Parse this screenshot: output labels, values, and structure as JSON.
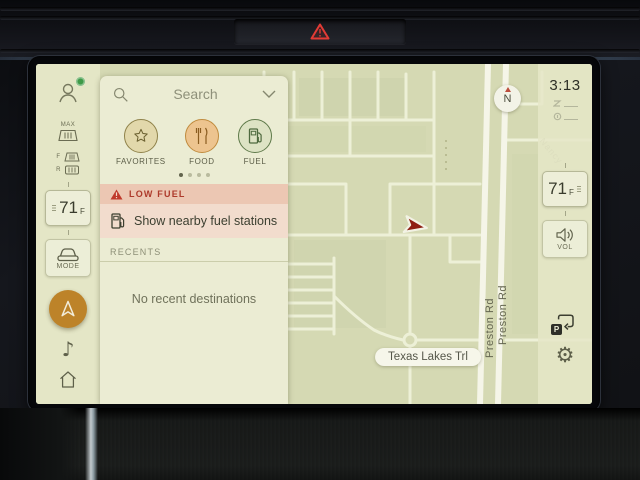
{
  "dashboard": {
    "hazard_button_icon": "hazard-warning-triangle"
  },
  "screen": {
    "left_rail": {
      "climate": {
        "max_label": "MAX",
        "front_label": "F",
        "rear_label": "R"
      },
      "temperature": {
        "value": "71",
        "unit": "F"
      },
      "mode_label": "MODE"
    },
    "search_panel": {
      "placeholder": "Search",
      "categories": [
        {
          "label": "FAVORITES",
          "icon": "star"
        },
        {
          "label": "FOOD",
          "icon": "fork-knife"
        },
        {
          "label": "FUEL",
          "icon": "fuel-pump"
        }
      ],
      "page_count": 4,
      "active_page": 1,
      "low_fuel": {
        "title": "LOW FUEL",
        "action": "Show nearby fuel stations"
      },
      "recents": {
        "title": "RECENTS",
        "empty": "No recent destinations"
      }
    },
    "map": {
      "compass": "N",
      "street_pill": "Texas Lakes Trl",
      "vertical_streets": [
        "Preston Rd",
        "Preston Rd"
      ],
      "faint_street": "Nancy"
    },
    "right_rail": {
      "time": "3:13",
      "temperature": {
        "value": "71",
        "unit": "F"
      },
      "volume_label": "VOL",
      "parking_letter": "P"
    }
  },
  "colors": {
    "accent_orange": "#bd8329",
    "alert_red": "#ad3a2b",
    "alert_bg": "#ecc7b3",
    "screen_cream": "#e7e9cc",
    "map_green": "#d5d9b3",
    "fuel_green": "#4e6a3e",
    "food_orange": "#c08b3e",
    "vehicle_marker": "#8e1d12"
  }
}
